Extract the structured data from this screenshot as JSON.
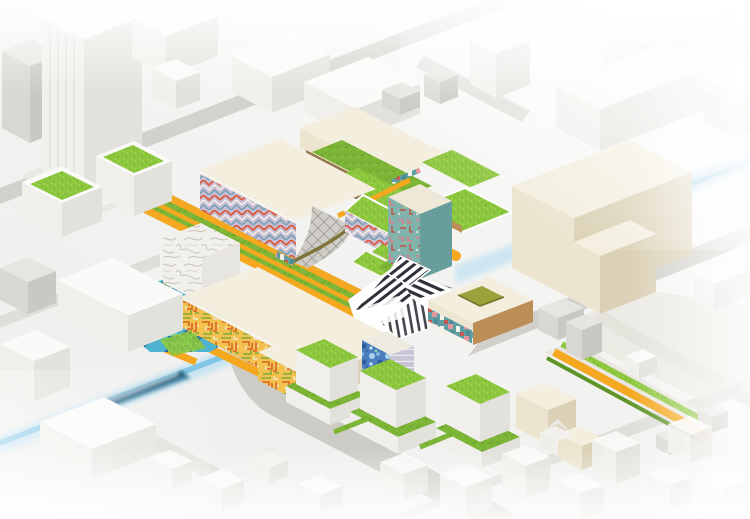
{
  "image": {
    "kind": "isometric-architecture-masterplan-render",
    "width_px": 750,
    "height_px": 519
  },
  "palette": {
    "bg": "#F1F1EF",
    "roadGray": "#CDCBC5",
    "roadLight": "#DAD8D3",
    "groundTint": "#E9E7E0",
    "whiteTop": "#FAFAF8",
    "whiteLeft": "#F0EFEB",
    "whiteRight": "#E2E1DC",
    "grayTop": "#E6E5E1",
    "grayLeft": "#D8D7D2",
    "grayRight": "#C9C8C2",
    "creamTop": "#F3EEDE",
    "creamLeft": "#ECE4CF",
    "creamRight": "#DBD1B6",
    "tan": "#BA8E55",
    "tanDark": "#A07840",
    "brown": "#8A6B3C",
    "olive": "#9AA23B",
    "orange": "#F5A81F",
    "orangeDark": "#E0920D",
    "grassBright": "#8DC73E",
    "grassMid": "#7DB636",
    "grassDark": "#5E9428",
    "hedge": "#4E7F46",
    "tealSolid": "#7FB5B2",
    "tealDark": "#679E9C",
    "lavender": "#C5BCD6",
    "riverBand": "#C7E4F2",
    "riverCore": "#79C2E4",
    "trainBody": "#2A6E8F",
    "trainDark": "#174F63",
    "dazzleInk": "#30303A",
    "chevRed": "#DD5A3A",
    "chevWhite": "#F2EDE4",
    "chevTeal": "#6FA0AE",
    "mazeBg": "#F2C14E",
    "mazeOrange": "#DB6F2C",
    "mazeGreen": "#8FAE3E",
    "mazeCream": "#EDE6CA",
    "mosaic1": "#2E9BC0",
    "mosaic2": "#1C6FA8",
    "mosaic3": "#4EC4B0",
    "mosaic4": "#7ED1A6",
    "mosaic5": "#2E5F9E",
    "bloomBg": "#4D7FBE",
    "bloom1": "#A9D3EC",
    "bloom2": "#2D5E9E",
    "bloom3": "#C9E4F4",
    "tealFaceBg": "#7FB3AC",
    "pinkAccent": "#D9808C",
    "redAccent": "#C2554A",
    "floorsBg": "#C9C4D6",
    "marbleBg": "#F1F0EC",
    "marbleLine": "#C6C2B8",
    "quiltBg": "#CFCDC7",
    "quiltLine": "#A19E96",
    "bandTeal": "#5E9EA2",
    "bandPink": "#E8949E",
    "bandWhite": "#F2EFE6",
    "bandRed": "#C75A50"
  },
  "scene": {
    "context": "white and gray city blocks on an isometric street grid, fading to white at the edges",
    "elements": [
      {
        "name": "finned-tower",
        "desc": "tall white tower with vertical fins, rounded pedestal, top-left"
      },
      {
        "name": "green-roof-cubes",
        "desc": "two white cubes with bright green lawn roofs, left"
      },
      {
        "name": "terraced-green-building",
        "desc": "stepped building with zigzag green roof terraces, tan walls and an orange ramp, top-center"
      },
      {
        "name": "chevron-hall",
        "desc": "cream hall with lavender/red chevron facade and gray quilted curved canopy"
      },
      {
        "name": "green-wedge-building",
        "desc": "chevron-faced block with sloped green lawn roof"
      },
      {
        "name": "teal-tower",
        "desc": "teal tower, patterned left face, cream cap, green terraces at base"
      },
      {
        "name": "dazzle-pavilion",
        "desc": "faceted plaza canopy with black-and-white stripes"
      },
      {
        "name": "courtyard-building",
        "desc": "cream slab with olive-green courtyard, tan sides, teal/pink mosaic band"
      },
      {
        "name": "maze-hall-large",
        "desc": "large cream hall, orange/green maze-pattern facade, white slide"
      },
      {
        "name": "maze-hall-small",
        "desc": "smaller block with same maze facade and tan side"
      },
      {
        "name": "marble-cube",
        "desc": "cube with gray marble-swirl pattern"
      },
      {
        "name": "water-mosaic-plaza",
        "desc": "triangulated teal/blue water plaza crossed by an orange zigzag path"
      },
      {
        "name": "podium-green-roofs",
        "desc": "row of white podium buildings with bright green roofs, bottom-center"
      },
      {
        "name": "bloom-cube",
        "desc": "cube with blue floral mosaic facade and lavender floor-striped side"
      },
      {
        "name": "big-cream-building",
        "desc": "large plain cream L-shaped building, right"
      },
      {
        "name": "orange-boulevard",
        "desc": "diagonal orange pedestrian spine with two grass stripes"
      },
      {
        "name": "linear-park",
        "desc": "orange path with green verges continuing to the lower right"
      },
      {
        "name": "river-transit-line",
        "desc": "light blue line crossing the whole scene diagonally"
      },
      {
        "name": "train",
        "desc": "motion-blurred blue train on the line, lower left"
      }
    ]
  }
}
